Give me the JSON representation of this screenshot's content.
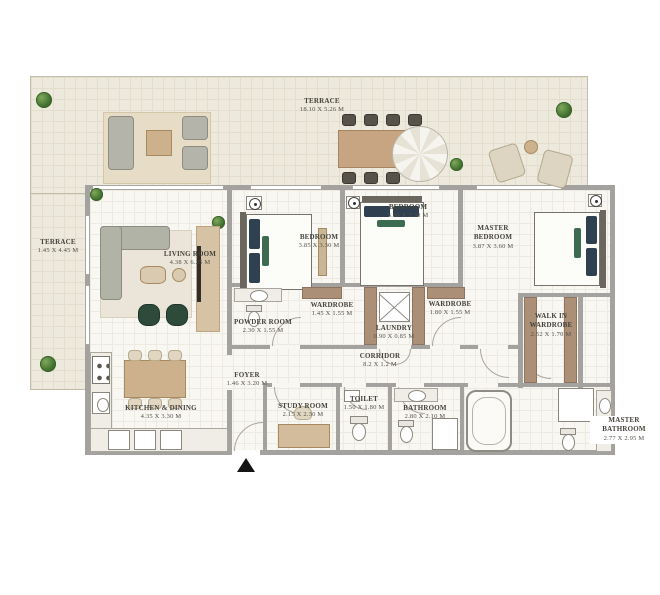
{
  "rooms": {
    "terrace_top": {
      "name": "TERRACE",
      "dims": "18.10 x 5.26 m"
    },
    "terrace_left": {
      "name": "TERRACE",
      "dims": "1.45 x 4.45 m"
    },
    "living": {
      "name": "LIVING ROOM",
      "dims": "4.38 x 6.25 m"
    },
    "bedroom1": {
      "name": "BEDROOM",
      "dims": "3.85 x 3.30 m"
    },
    "bedroom2": {
      "name": "BEDROOM",
      "dims": "3.50 x 3.30 m"
    },
    "master_bedroom": {
      "name": "MASTER BEDROOM",
      "dims": "3.87 x 3.60 m"
    },
    "powder": {
      "name": "POWDER ROOM",
      "dims": "2.30 x 1.55 m"
    },
    "wardrobe1": {
      "name": "WARDROBE",
      "dims": "1.45 x 1.55 m"
    },
    "wardrobe2": {
      "name": "WARDROBE",
      "dims": "1.80 x 1.55 m"
    },
    "laundry": {
      "name": "LAUNDRY",
      "dims": "0.90 x 0.85 m"
    },
    "corridor": {
      "name": "CORRIDOR",
      "dims": "8.2 x 1.2 m"
    },
    "walk_in": {
      "name": "WALK IN WARDROBE",
      "dims": "2.52 x 1.70 m"
    },
    "foyer": {
      "name": "FOYER",
      "dims": "1.46 x 3.20 m"
    },
    "kitchen": {
      "name": "KITCHEN & DINING",
      "dims": "4.35 x 3.30 m"
    },
    "study": {
      "name": "STUDY ROOM",
      "dims": "2.15 x 2.30 m"
    },
    "toilet": {
      "name": "TOILET",
      "dims": "1.50 x 1.80 m"
    },
    "bathroom": {
      "name": "BATHROOM",
      "dims": "2.80 x 2.10 m"
    },
    "master_bathroom": {
      "name": "MASTER BATHROOM",
      "dims": "2.77 x 2.95 m"
    }
  },
  "icons": {
    "entrance_arrow": "▲"
  },
  "colors": {
    "wall": "#a3a29e",
    "terrace_floor": "#edeadd",
    "interior_floor": "#f8f7f2",
    "wardrobe_tan": "#ab8f77",
    "wood": "#cdb18c",
    "sofa_gray": "#b4b4ab",
    "pillow_navy": "#2f4050",
    "accent_green": "#3d6b52",
    "plant_green": "#41702f"
  }
}
